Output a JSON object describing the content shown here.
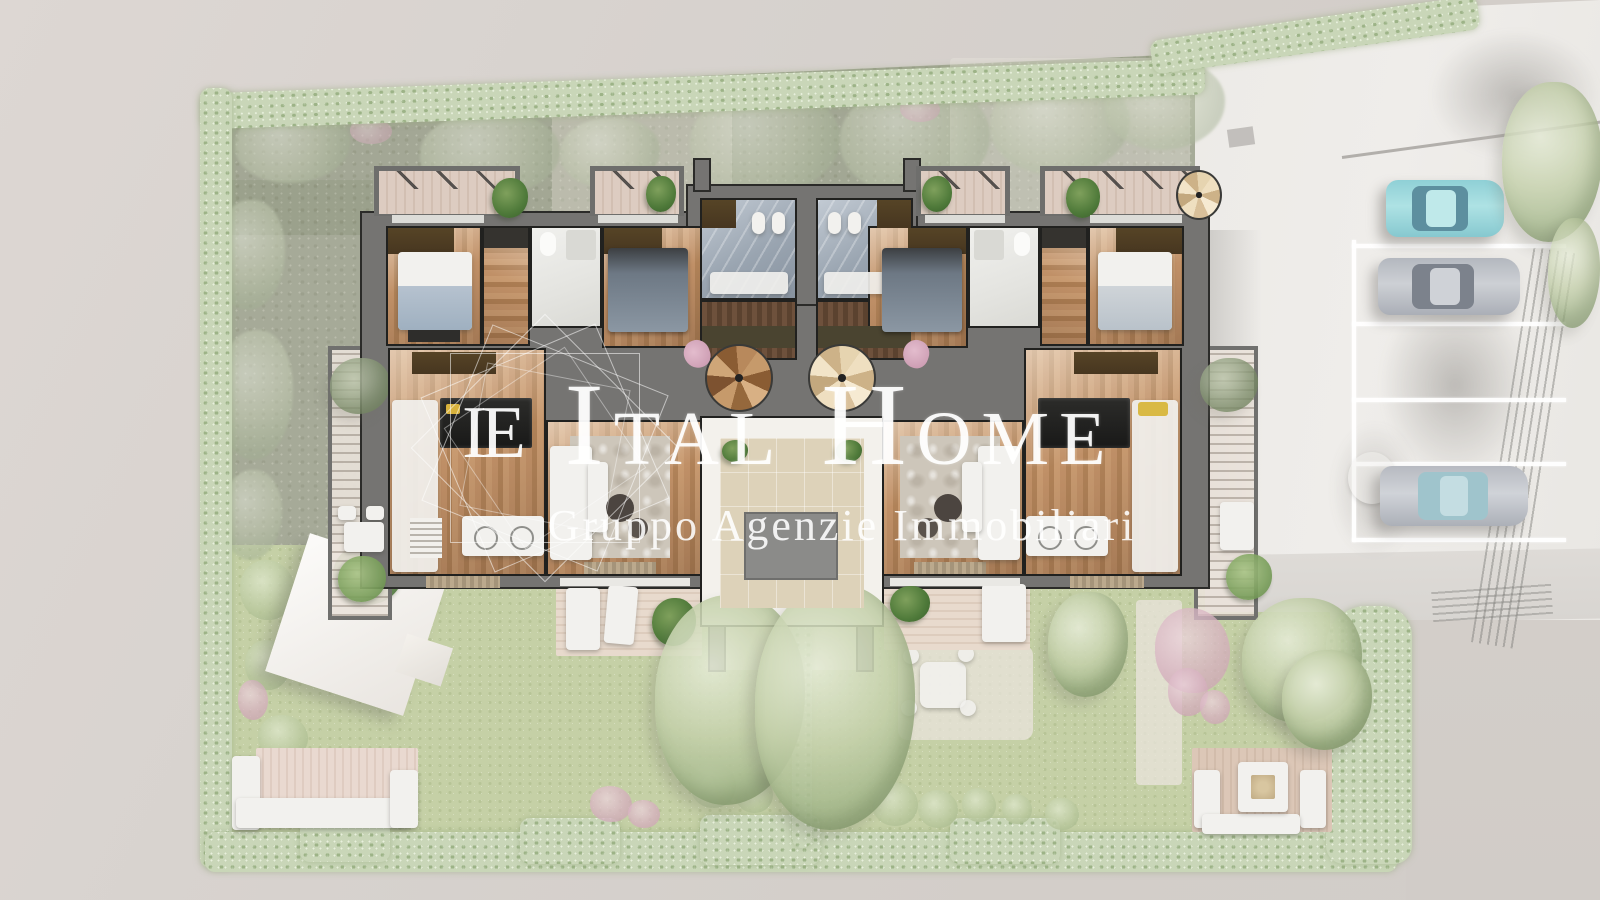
{
  "watermark": {
    "logo_monogram": "IE",
    "title_word1_initial": "I",
    "title_word1_rest": "TAL",
    "title_word2_initial": "H",
    "title_word2_rest": "OME",
    "subtitle": "Gruppo Agenzie Immobiliari"
  },
  "scene": {
    "type": "top-down architectural floor plan render of twin residential units with gardens and parking",
    "cars": [
      {
        "name": "car-teal"
      },
      {
        "name": "car-gray-upper"
      },
      {
        "name": "car-gray-lower"
      }
    ]
  },
  "colors": {
    "bg": "#d6d1cd",
    "driveway": "#edebe7",
    "pavement": "#dcd9d6",
    "olive": "#9aa08b",
    "lawn_faded": "#c5d0a6",
    "hedge": "#c9d6b8",
    "wall": "#757472",
    "wall_line": "#2b2b29",
    "wood": "#b98c63",
    "wood_dark": "#6b4a33",
    "wardrobe": "#4c3b23",
    "bath": "#eaeae7",
    "marble": "#a4aeb9",
    "beige": "#ddd2b9",
    "court_gray": "#8b8b89",
    "deck": "#e4d6cb",
    "sofa": "#f2f1ee",
    "car_teal": "#a5dcdf",
    "car_gray": "#c2c5cb",
    "pink_chair": "#d7aabe",
    "watermark_white": "#ffffff"
  }
}
